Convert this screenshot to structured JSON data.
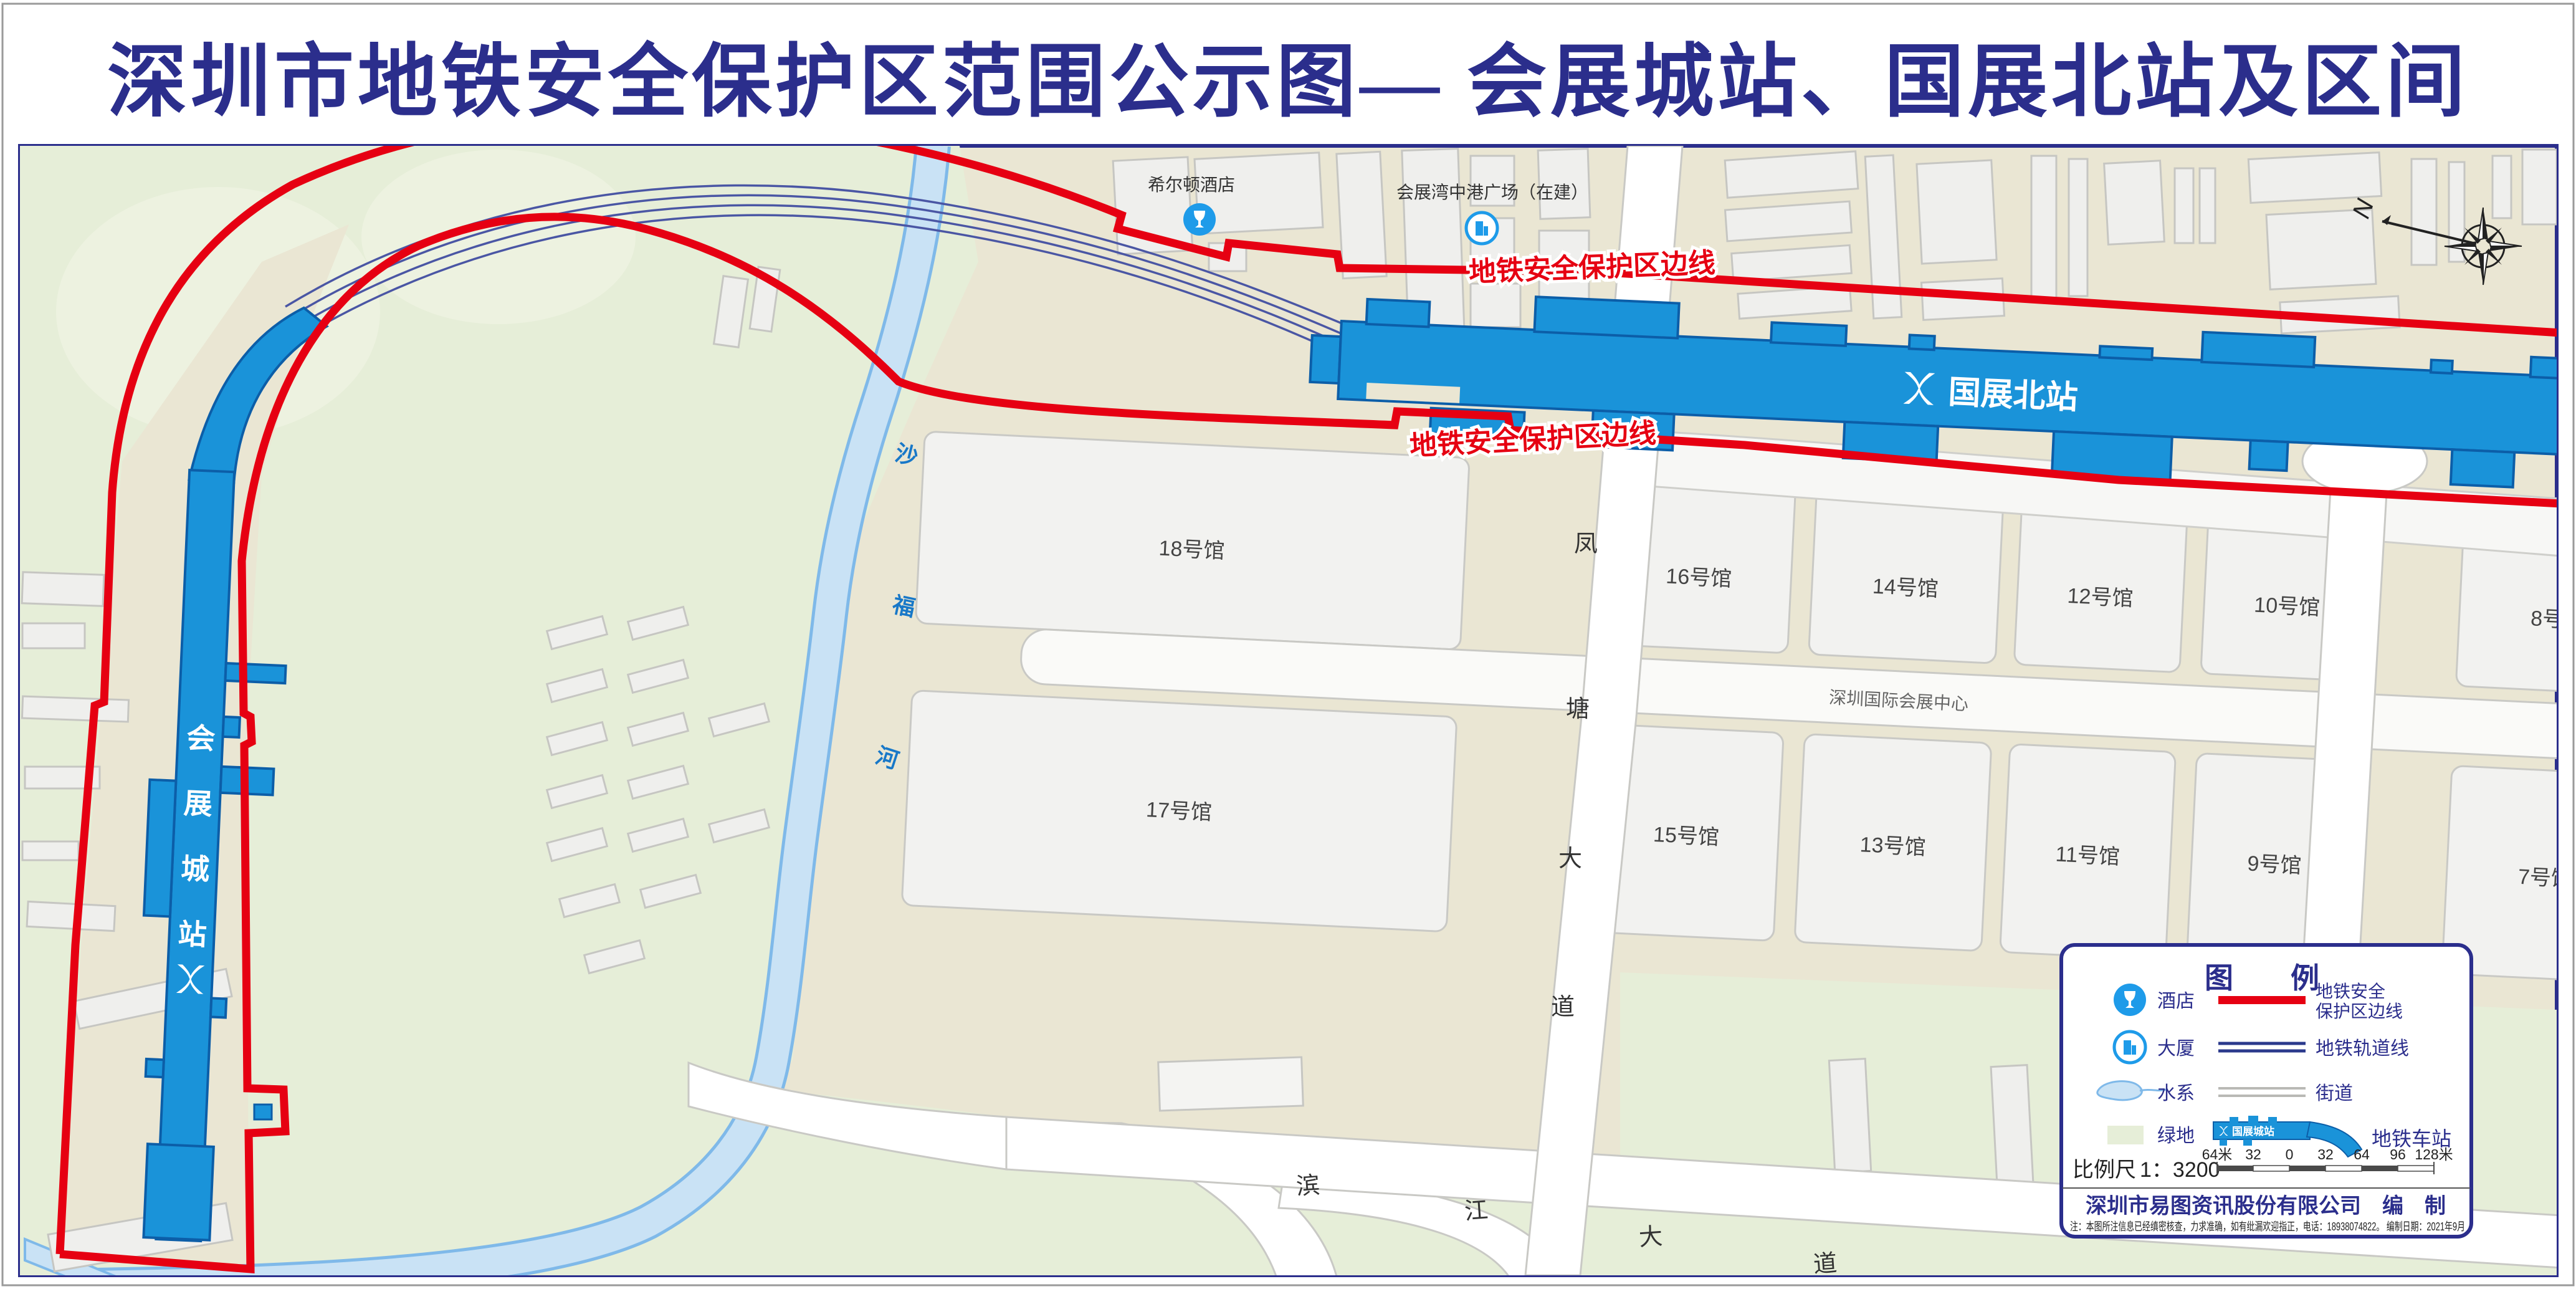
{
  "title": "深圳市地铁安全保护区范围公示图— 会展城站、国展北站及区间",
  "map": {
    "boundary_label": "地铁安全保护区边线",
    "stations": [
      {
        "id": "guozhanbei",
        "label": "国展北站"
      },
      {
        "id": "huizhancheng",
        "chars": [
          "会",
          "展",
          "城",
          "站"
        ]
      }
    ],
    "pois": [
      {
        "icon": "hotel-icon",
        "label": "希尔顿酒店"
      },
      {
        "icon": "building-icon",
        "label": "会展湾中港广场（在建）"
      }
    ],
    "river": {
      "chars": [
        "沙",
        "福",
        "河"
      ]
    },
    "roads": [
      {
        "name": "凤塘大道",
        "chars": [
          "凤",
          "塘",
          "大",
          "道"
        ]
      },
      {
        "name": "滨江大道",
        "chars": [
          "滨",
          "江",
          "大",
          "道"
        ]
      }
    ],
    "venue_label": "深圳国际会展中心",
    "halls_upper": [
      "18号馆",
      "16号馆",
      "14号馆",
      "12号馆",
      "10号馆",
      "8号馆"
    ],
    "halls_lower": [
      "17号馆",
      "15号馆",
      "13号馆",
      "11号馆",
      "9号馆",
      "7号馆"
    ],
    "compass_label": "N"
  },
  "legend": {
    "title": "图　　例",
    "items_left": [
      {
        "icon": "hotel-icon",
        "label": "酒店"
      },
      {
        "icon": "building-icon",
        "label": "大厦"
      },
      {
        "icon": "water-icon",
        "label": "水系"
      },
      {
        "icon": "green-swatch",
        "label": "绿地"
      }
    ],
    "items_right": [
      {
        "symbol": "red-line",
        "label_lines": [
          "地铁安全",
          "保护区边线"
        ]
      },
      {
        "symbol": "rail-lines",
        "label": "地铁轨道线"
      },
      {
        "symbol": "street-lines",
        "label": "街道"
      },
      {
        "symbol": "station-shape",
        "label": "地铁车站",
        "sample_text": "国展城站"
      }
    ],
    "scale": {
      "label": "比例尺",
      "ratio": "1：3200",
      "ticks": [
        "64米",
        "32",
        "0",
        "32",
        "64",
        "96",
        "128米"
      ]
    },
    "publisher": "深圳市易图资讯股份有限公司　编　制",
    "note": "注：本图所注信息已经缜密核查，力求准确，如有纰漏欢迎指正，电话：18938074822。 编制日期：2021年9月"
  },
  "colors": {
    "title_navy": "#2B2E8C",
    "protect_red": "#E60012",
    "metro_blue": "#1A93D9",
    "metro_blue_dark": "#0C5EA8",
    "map_beige": "#EAE6D3",
    "green_area": "#E6EED8",
    "river_fill": "#C9E2F5",
    "river_edge": "#7FB9E9",
    "track_navy": "#4A56A4"
  }
}
